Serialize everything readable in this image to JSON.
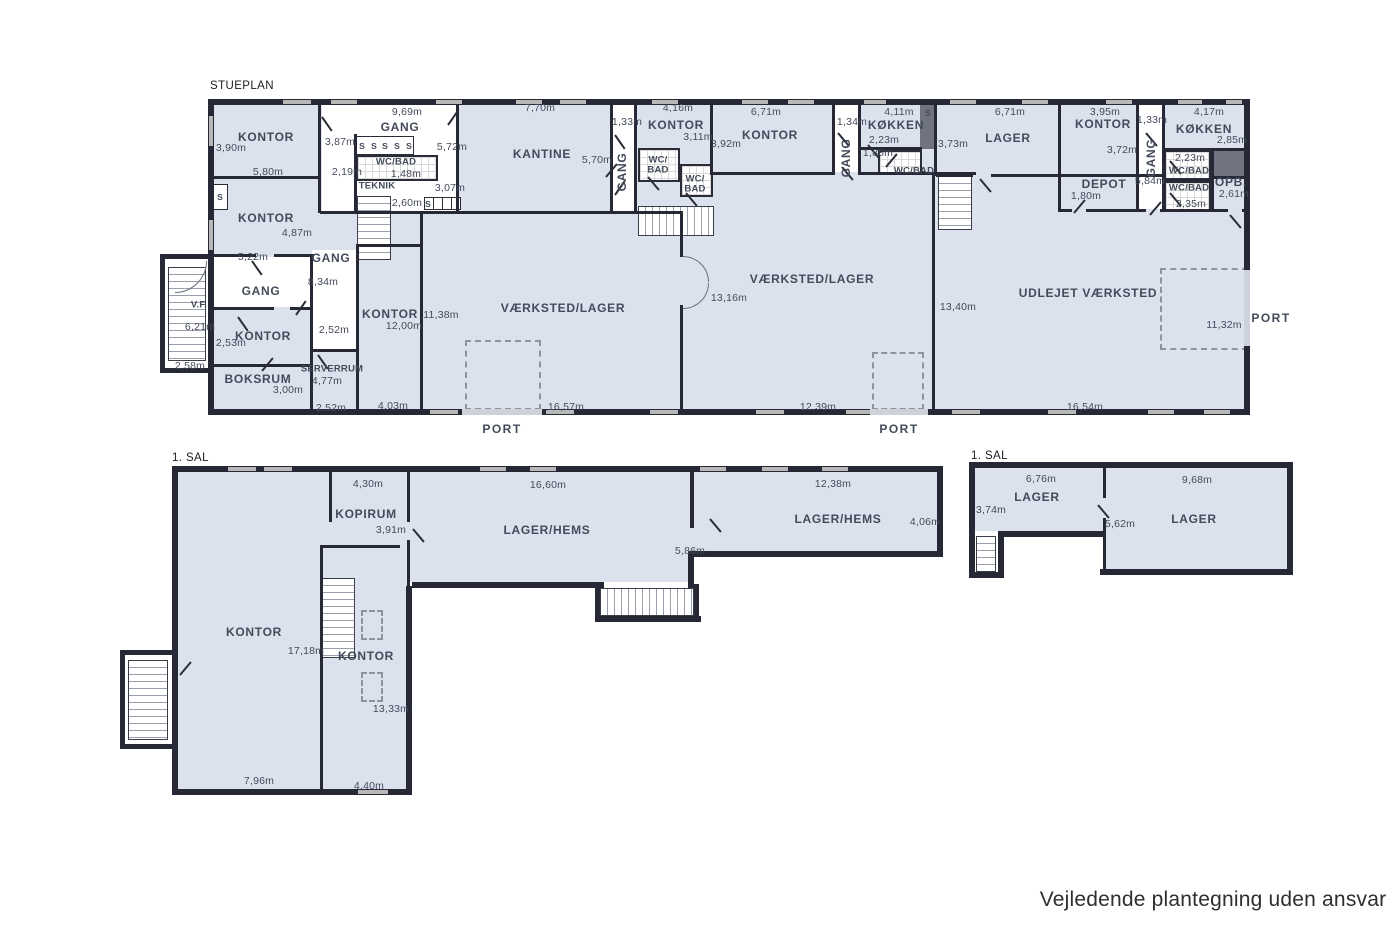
{
  "colors": {
    "room_fill": "#dce2ed",
    "wall": "#262935",
    "window": "#b8b8b8"
  },
  "footer": {
    "disclaimer": "Vejledende plantegning uden ansvar"
  },
  "sp": {
    "label": "STUEPLAN",
    "port": "PORT",
    "s": "S",
    "kontor_nw": {
      "name": "KONTOR",
      "h": "3,90m",
      "w": "5,80m"
    },
    "gang_top": {
      "name": "GANG",
      "w": "9,69m",
      "door": "3,87m"
    },
    "wcbad_top": {
      "name": "WC/BAD",
      "w": "1,48m",
      "door": "2,19m"
    },
    "teknik": {
      "name": "TEKNIK",
      "w": "2,60m",
      "d2": "3,07m"
    },
    "kitchenette": {
      "w": "5,72m"
    },
    "kontor_w2": {
      "name": "KONTOR",
      "h": "4,87m",
      "w": "5,22m"
    },
    "gang_mid": {
      "name": "GANG",
      "h": "8,34m"
    },
    "gang_entry": {
      "name": "GANG"
    },
    "vf": {
      "name": "V.F.",
      "h": "6,21m",
      "w": "2,58m"
    },
    "kontor_sm": {
      "name": "KONTOR",
      "h": "2,53m",
      "w": "2,52m"
    },
    "boksrum": {
      "name": "BOKSRUM",
      "h": "3,00m"
    },
    "serverrum": {
      "name": "SERVERRUM",
      "h": "4,77m",
      "w": "2,52m"
    },
    "kontor_12": {
      "name": "KONTOR",
      "h": "12,00m",
      "w": "4,03m"
    },
    "vl1": {
      "name": "VÆRKSTED/LAGER",
      "h": "11,38m",
      "w": "16,57m"
    },
    "kantine": {
      "name": "KANTINE",
      "w": "7,70m",
      "h": "5,70m"
    },
    "gang_v1": {
      "name": "GANG",
      "w": "1,33m"
    },
    "kontor_3": {
      "name": "KONTOR",
      "w": "4,16m",
      "h": "3,11m"
    },
    "wcbad_a": {
      "name": "WC/\nBAD"
    },
    "wcbad_b": {
      "name": "WC/\nBAD"
    },
    "kontor_4": {
      "name": "KONTOR",
      "w": "6,71m",
      "h": "3,92m"
    },
    "gang_v2": {
      "name": "GANG",
      "w": "1,34m"
    },
    "koekken_m": {
      "name": "KØKKEN",
      "w": "4,11m",
      "h": "2,23m"
    },
    "wcbad_m": {
      "name": "WC/BAD",
      "w": "1,88m"
    },
    "vl2": {
      "name": "VÆRKSTED/LAGER",
      "door": "13,16m",
      "h": "13,40m",
      "w": "12,39m"
    },
    "lager": {
      "name": "LAGER",
      "w": "6,71m",
      "h": "3,73m"
    },
    "kontor_5": {
      "name": "KONTOR",
      "w": "3,95m",
      "h": "3,72m"
    },
    "depot": {
      "name": "DEPOT",
      "w": "1,80m"
    },
    "gang_v3": {
      "name": "GANG",
      "w": "1,33m",
      "h": "5,84m"
    },
    "koekken_r": {
      "name": "KØKKEN",
      "w": "4,17m",
      "h": "2,85m"
    },
    "wcbad_r1": {
      "name": "WC/BAD",
      "w": "2,23m"
    },
    "wcbad_r2": {
      "name": "WC/BAD",
      "w": "2,35m"
    },
    "opb": {
      "name": "OPB.",
      "h": "2,61m"
    },
    "udlejet": {
      "name": "UDLEJET VÆRKSTED",
      "w": "16,54m",
      "port_w": "11,32m"
    }
  },
  "s1l": {
    "label": "1. SAL",
    "kopirum": {
      "name": "KOPIRUM",
      "w": "4,30m",
      "h": "3,91m"
    },
    "hems1": {
      "name": "LAGER/HEMS",
      "w": "16,60m",
      "step": "5,86m"
    },
    "hems2": {
      "name": "LAGER/HEMS",
      "w": "12,38m",
      "h": "4,06m"
    },
    "kontor_a": {
      "name": "KONTOR",
      "h": "17,18m",
      "w": "7,96m"
    },
    "kontor_b": {
      "name": "KONTOR",
      "h": "13,33m",
      "w": "4,40m"
    }
  },
  "s1r": {
    "label": "1. SAL",
    "lager_a": {
      "name": "LAGER",
      "w": "6,76m",
      "h": "3,74m"
    },
    "lager_b": {
      "name": "LAGER",
      "w": "9,68m",
      "h": "5,62m"
    }
  }
}
